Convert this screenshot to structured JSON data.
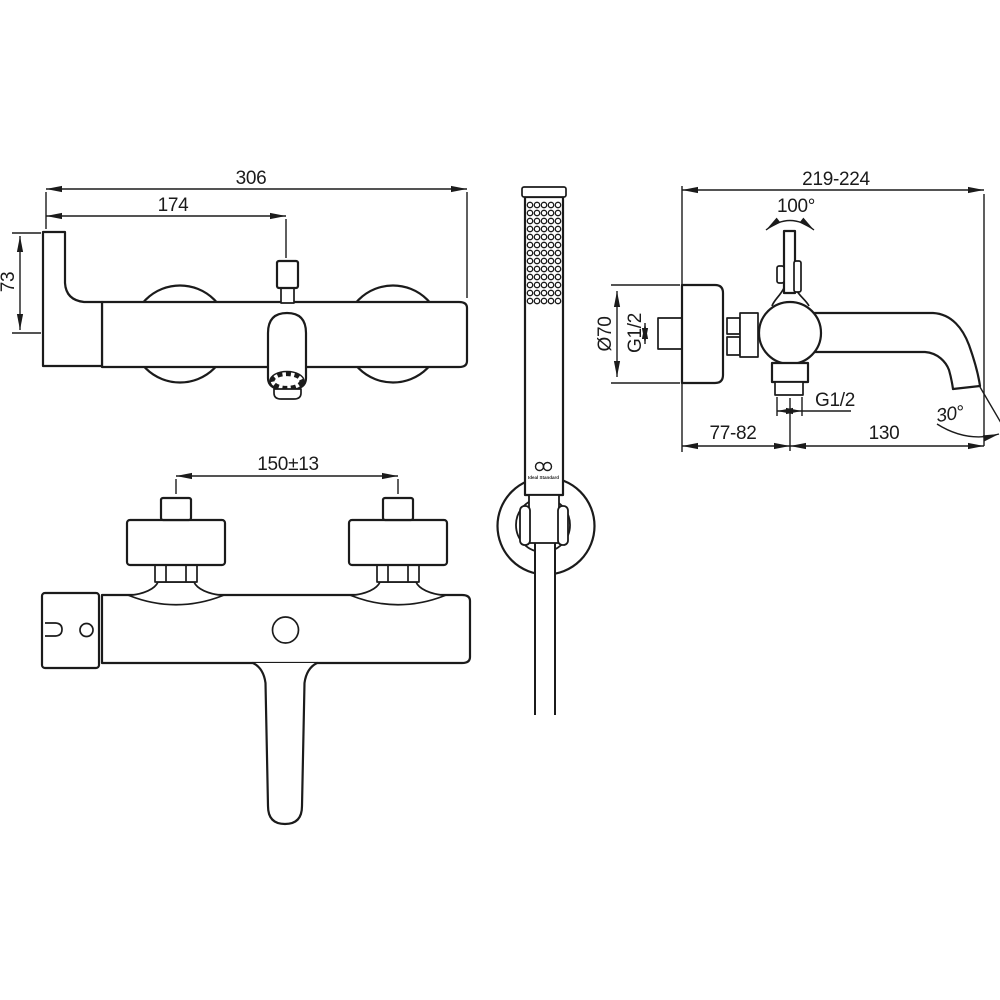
{
  "drawing": {
    "title": "bath-shower-mixer-dimension-drawing",
    "line_color": "#1b1b1b",
    "background": "#ffffff"
  },
  "front_view": {
    "overall_width": "306",
    "diverter_offset": "174",
    "handle_height": "73"
  },
  "side_view": {
    "wall_to_spout": "219-224",
    "handle_swing_angle": "100°",
    "escutcheon_diameter": "Ø70",
    "inlet_thread": "G1/2",
    "outlet_thread": "G1/2",
    "wall_to_outlet": "77-82",
    "outlet_to_spout_tip": "130",
    "spout_end_angle": "30°"
  },
  "plan_view": {
    "inlet_centres": "150±13"
  },
  "hand_shower": {
    "logo_text": "Ideal Standard",
    "spray": {
      "rows": 13,
      "cols": 5
    }
  }
}
